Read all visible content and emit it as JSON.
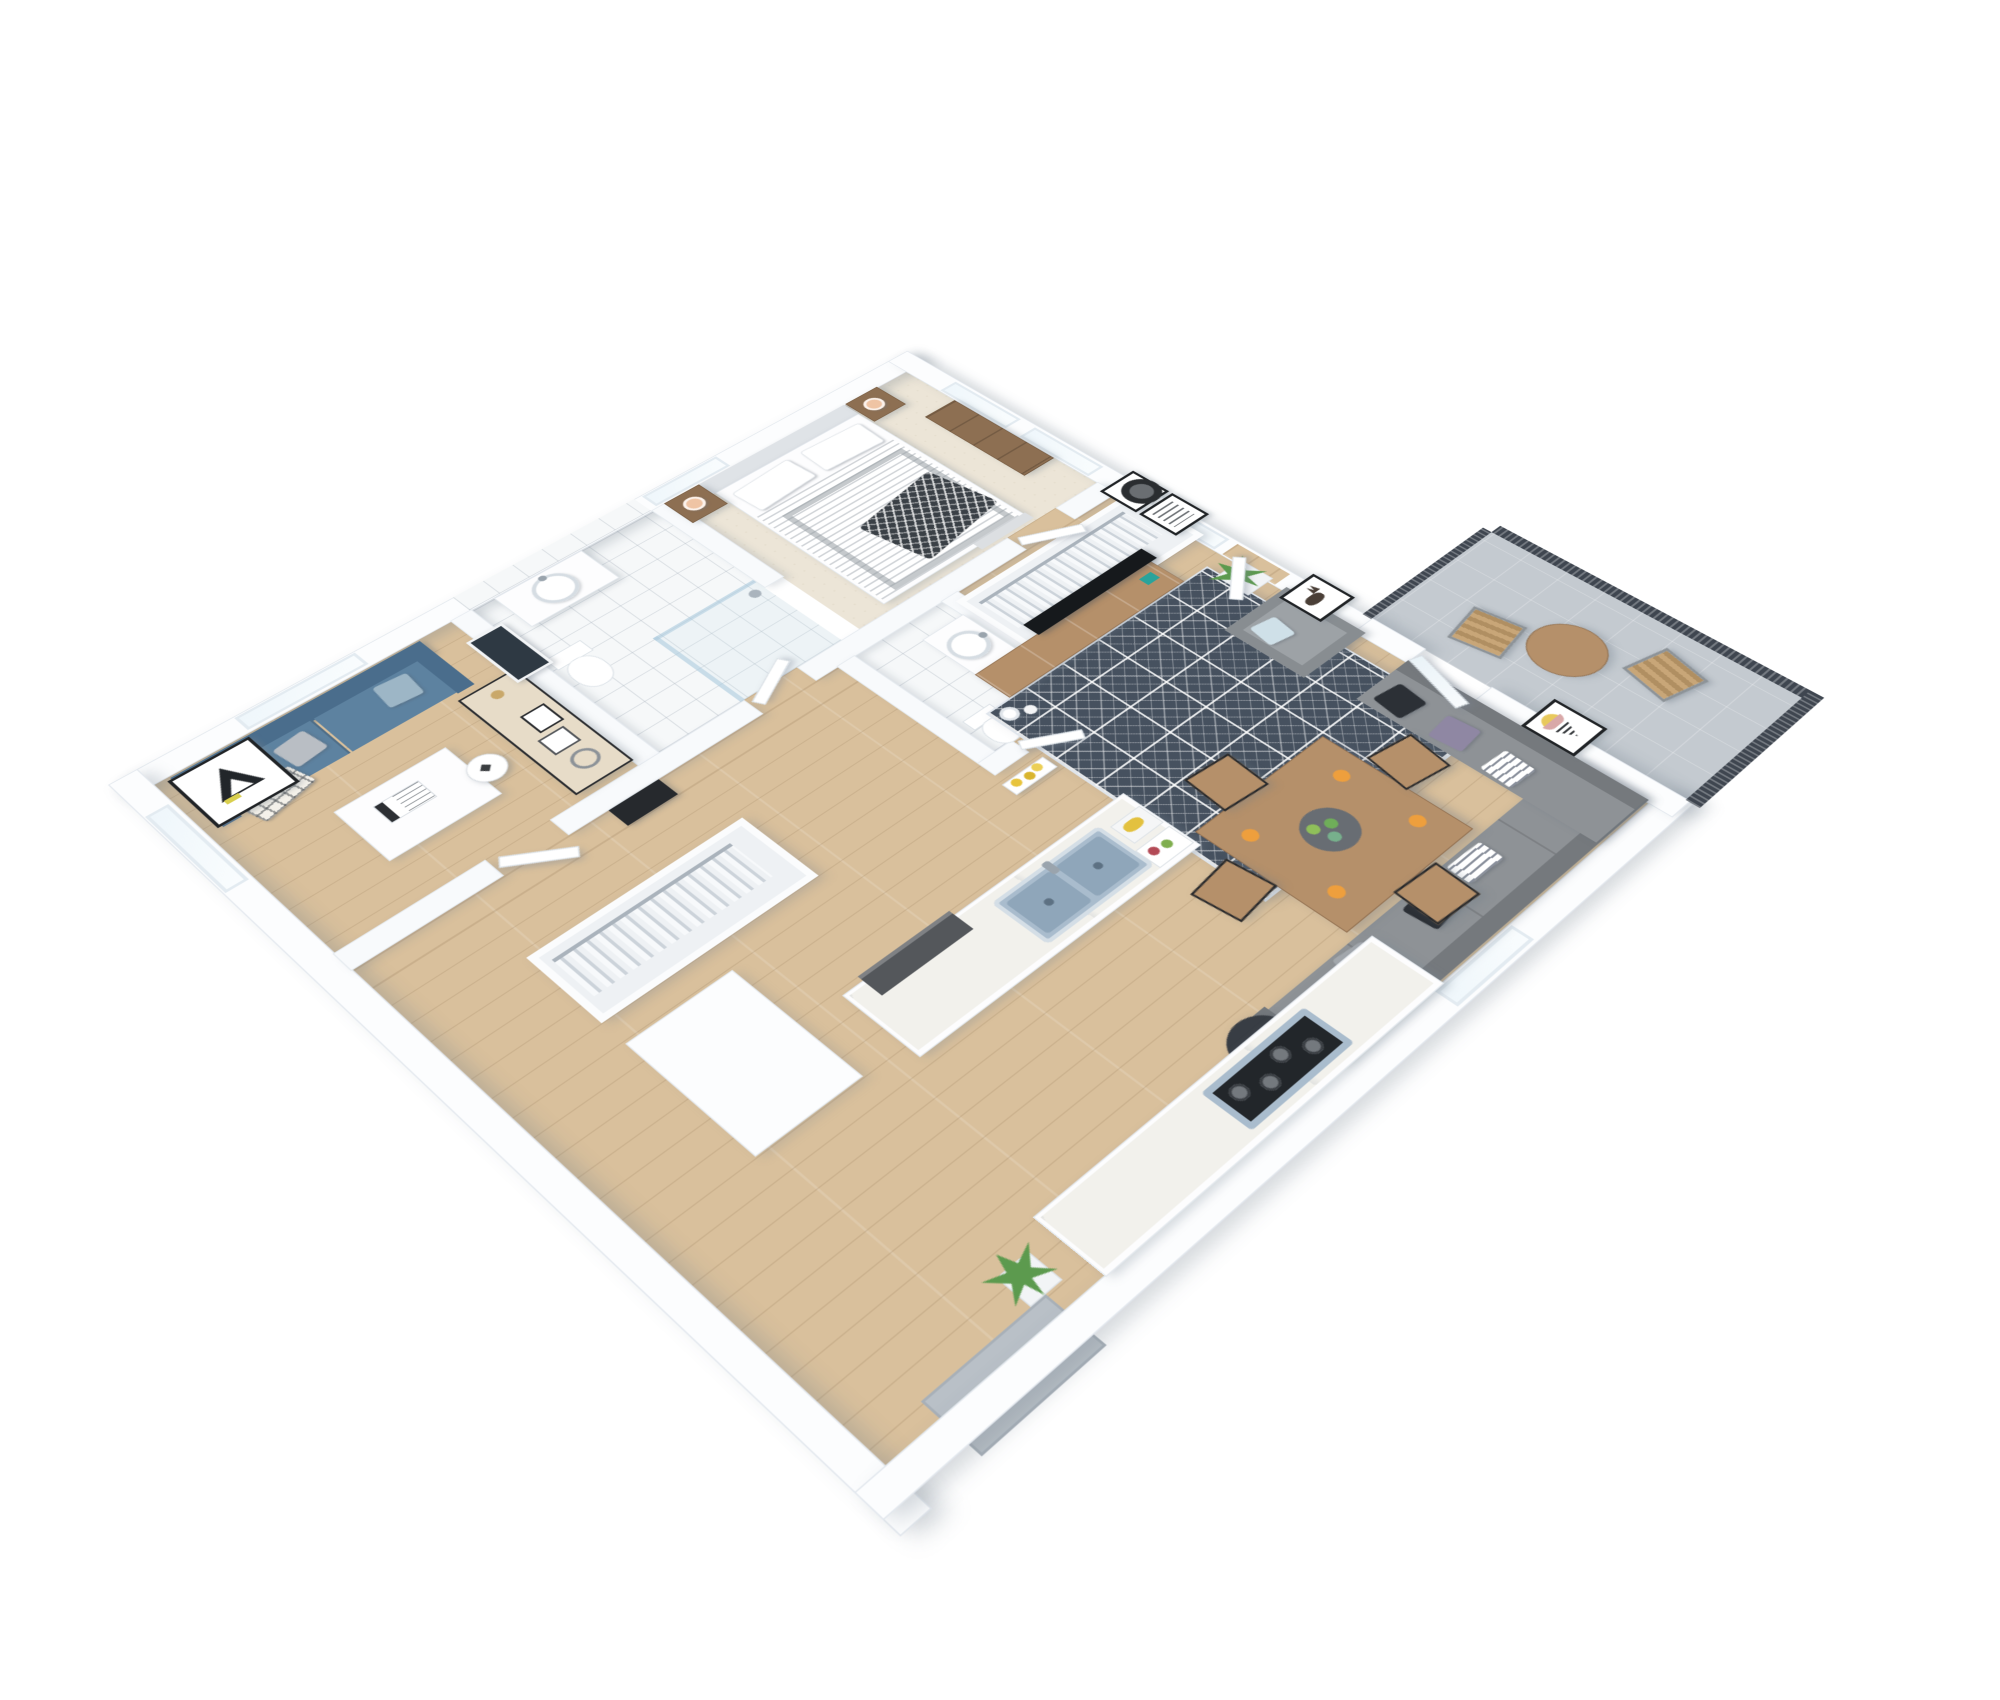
{
  "meta": {
    "title": "3D Apartment Floor Plan — Axonometric Render",
    "type": "architectural-visualization",
    "view": "isometric top-down cutaway",
    "background": "#ffffff"
  },
  "palette": {
    "wall": "#fcfdfe",
    "wood_floor": "#d9c09c",
    "carpet": "#ece5d7",
    "tile": "#f6f8f9",
    "balcony_floor": "#c4cad0",
    "rug_navy": "#46515f",
    "sofa_blue": "#5d82a0",
    "sofa_blue_dark": "#4a6d8c",
    "sectional_gray": "#8e9296",
    "sectional_gray_dark": "#75797d",
    "armchair_gray": "#888d91",
    "wood_furniture": "#b5906a",
    "wood_dark": "#8d6f52",
    "tv_black": "#16191c",
    "sink_steel": "#a9bccd",
    "lamp_peach": "#efc4a4",
    "plant_green": "#5c9a4e",
    "accent_orange": "#ee9f3d",
    "railing_dark": "#3f4650",
    "marble_side_table": "#383d44"
  },
  "rooms": {
    "bedroom": {
      "label": "Bedroom",
      "items": [
        "double bed with gray striped duvet",
        "upholstered headboard",
        "2 white pillows",
        "dark chevron throw blanket",
        "2 wooden nightstands",
        "2 peach table lamps",
        "wooden dresser",
        "cream carpet",
        "2 tall windows"
      ]
    },
    "master_bathroom": {
      "label": "En-suite Bathroom",
      "items": [
        "white vanity with round basin",
        "chrome faucet",
        "toilet",
        "walk-in shower with glass screen",
        "white wall tiles",
        "tiled floor"
      ]
    },
    "office": {
      "label": "Office / Den",
      "items": [
        "blue two-seat sofa",
        "checkered pillow",
        "gray pillow",
        "light blue pillow",
        "plaid throw",
        "white coffee table",
        "magazine",
        "writing desk",
        "white shell chair",
        "brass desk lamp",
        "picture frames",
        "wire basket",
        "chalkboard poster",
        "geometric wall art",
        "windows"
      ]
    },
    "hallway": {
      "label": "Hallway",
      "items": [
        "entry closet with hanging clothes",
        "wall shelf with yellow flowers",
        "white interior doors",
        "dark media bench"
      ]
    },
    "guest_bathroom": {
      "label": "Guest Bathroom",
      "items": [
        "vanity with round washbasin",
        "chrome faucet",
        "toilet"
      ]
    },
    "walk_in_closet": {
      "label": "Walk-in Closet",
      "items": [
        "clothes rail",
        "hanging white shirts"
      ]
    },
    "living_room": {
      "label": "Living Room",
      "items": [
        "wall-mounted TV",
        "wooden media console",
        "teal decor box",
        "white vase",
        "pillar candle",
        "geometric navy area rug",
        "gray corner sectional sofa",
        "black pillows",
        "lilac pillows",
        "striped pillows",
        "gray armchair",
        "light blue cushion",
        "dark marble side table with white tray",
        "potted plant"
      ]
    },
    "dining_area": {
      "label": "Dining Area",
      "items": [
        "square wooden dining table",
        "4 metal-frame wooden chairs",
        "gray serving plate with green fruit",
        "4 oranges"
      ]
    },
    "kitchen": {
      "label": "Kitchen",
      "items": [
        "island with marble counter",
        "double-basin steel sink",
        "chrome faucet",
        "built-in dishwasher",
        "white base cabinets",
        "gas cooktop with 4 burners",
        "cutting board with produce",
        "tray with bananas and greens",
        "tall white cabinet"
      ]
    },
    "balcony": {
      "label": "Balcony",
      "items": [
        "round wooden bistro table",
        "2 metal chairs with wood slats",
        "dark slatted railing",
        "gray tiled floor",
        "glass balcony door"
      ]
    },
    "entry": {
      "label": "Entry",
      "items": [
        "recessed entrance niche",
        "entrance door",
        "potted plant"
      ]
    }
  },
  "wall_art": {
    "office_triangle": "Penrose triangle print",
    "chalkboard": "dark chalkboard poster",
    "circle_print": "black ink circle print",
    "typography_print": "black-and-white typography poster",
    "deer_print": "deer line-art print",
    "cone_print": "geometric cone print with yellow and pink arcs"
  },
  "counts": {
    "windows": 7,
    "interior_doors": 6,
    "dining_chairs": 4,
    "balcony_chairs": 2,
    "plants": 3
  }
}
